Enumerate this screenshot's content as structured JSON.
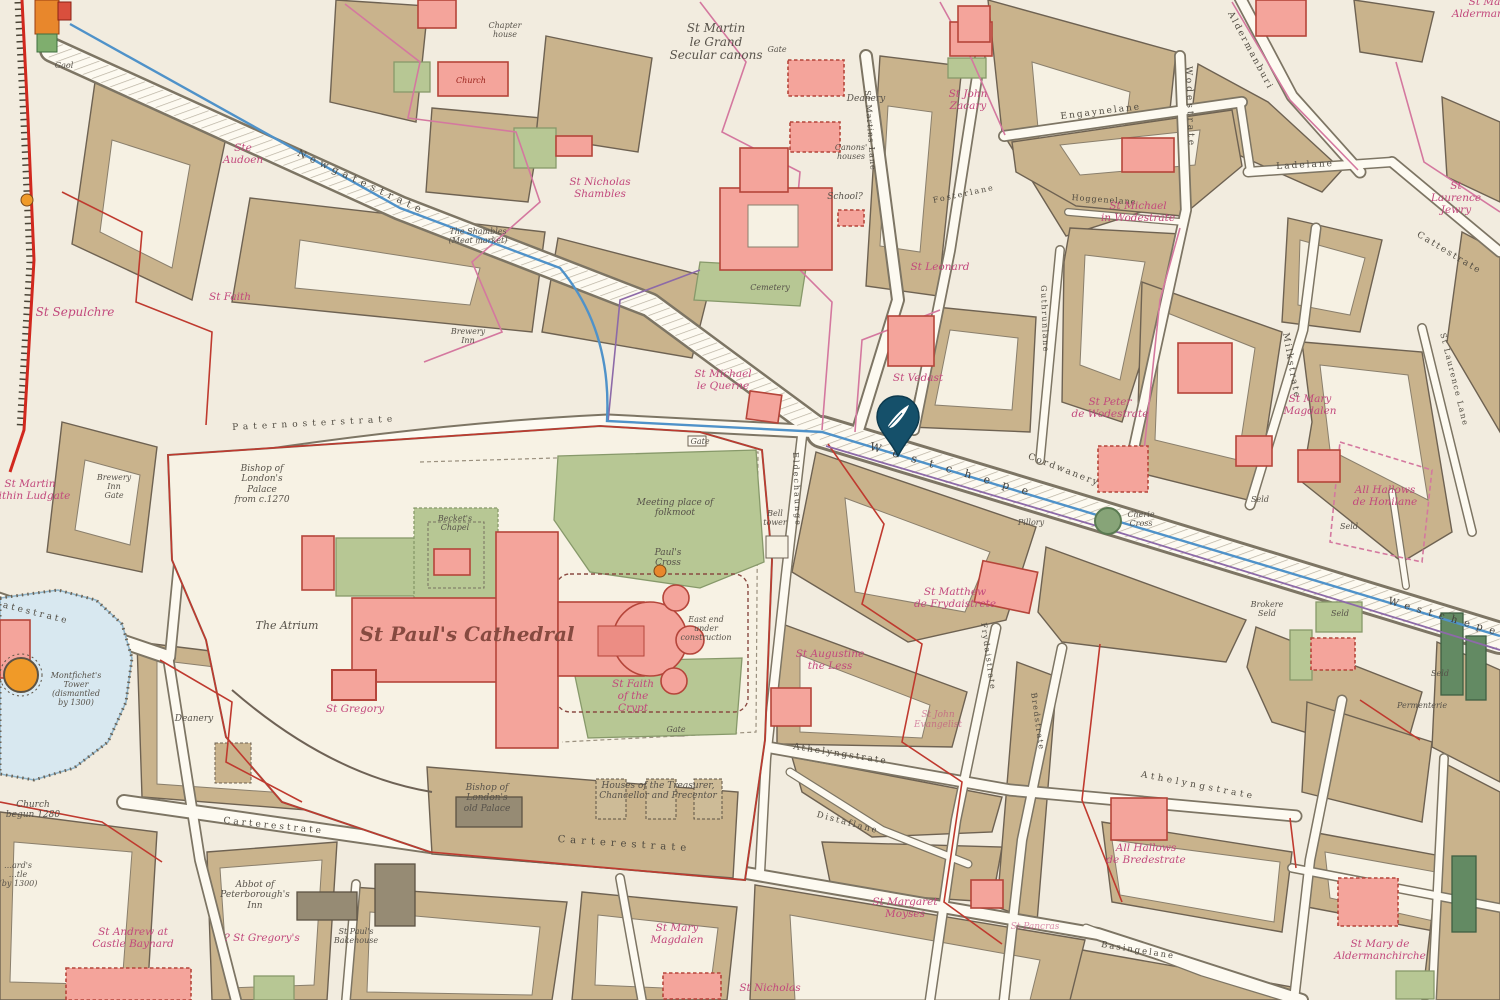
{
  "map": {
    "kind": "historical-city-map-medieval-london",
    "marker": {
      "name": "location-pin",
      "color": "#15506a",
      "glyph": "quill"
    },
    "palette": {
      "parchment": "#f2ecdf",
      "block_tan": "#c9b38c",
      "street": "#fdfaf1",
      "church_pink": "#f4a49b",
      "green": "#b7c794",
      "dark_green": "#638a63",
      "water": "#d8e8f0",
      "wall_red": "#d1281e",
      "boundary_pink": "#d4789f",
      "boundary_crimson": "#bf3a2f",
      "conduit_blue": "#4f92c9",
      "label_pink": "#c2487c",
      "pin": "#15506a"
    },
    "labels": [
      {
        "id": "lbl-gaol",
        "t": "Gaol",
        "x": 64,
        "y": 62,
        "c": "place-xs"
      },
      {
        "id": "lbl-chapter-house",
        "t": "Chapter\nhouse",
        "x": 505,
        "y": 22,
        "c": "place-xs"
      },
      {
        "id": "lbl-church-greyfriars",
        "t": "Church",
        "x": 471,
        "y": 76,
        "c": "red-sm"
      },
      {
        "id": "lbl-ste-audoen",
        "t": "Ste\nAudoen",
        "x": 243,
        "y": 142,
        "c": "church"
      },
      {
        "id": "lbl-st-sepulchre",
        "t": "St Sepulchre",
        "x": 75,
        "y": 306,
        "c": "church",
        "f": 12
      },
      {
        "id": "lbl-st-faith",
        "t": "St Faith",
        "x": 230,
        "y": 291,
        "c": "church"
      },
      {
        "id": "lbl-st-nicholas-shambles",
        "t": "St Nicholas\nShambles",
        "x": 600,
        "y": 176,
        "c": "church"
      },
      {
        "id": "lbl-shambles",
        "t": "The Shambles\n(Meat market)",
        "x": 478,
        "y": 228,
        "c": "place-xs"
      },
      {
        "id": "lbl-newgatestrate",
        "t": "Newgatestrate",
        "x": 300,
        "y": 148,
        "c": "street",
        "r": 25,
        "s": 5,
        "f": 10
      },
      {
        "id": "lbl-st-martin-le-grand",
        "t": "St Martin\nle Grand\nSecular canons",
        "x": 716,
        "y": 22,
        "c": "place",
        "f": 12
      },
      {
        "id": "lbl-gate-martin",
        "t": "Gate",
        "x": 777,
        "y": 46,
        "c": "place-xs"
      },
      {
        "id": "lbl-deanery-martin",
        "t": "Deanery",
        "x": 866,
        "y": 94,
        "c": "place-sm"
      },
      {
        "id": "lbl-canons-houses",
        "t": "Canons'\nhouses",
        "x": 851,
        "y": 144,
        "c": "place-xs"
      },
      {
        "id": "lbl-school",
        "t": "School?",
        "x": 845,
        "y": 192,
        "c": "place-sm"
      },
      {
        "id": "lbl-st-john-zacary",
        "t": "St John\nZacary",
        "x": 968,
        "y": 88,
        "c": "church"
      },
      {
        "id": "lbl-st-leonard",
        "t": "St Leonard",
        "x": 940,
        "y": 261,
        "c": "church"
      },
      {
        "id": "lbl-cemetery",
        "t": "Cemetery",
        "x": 770,
        "y": 284,
        "c": "place-xs"
      },
      {
        "id": "lbl-st-michael-le-querne",
        "t": "St Michael\nle Querne",
        "x": 723,
        "y": 368,
        "c": "church"
      },
      {
        "id": "lbl-st-vedast",
        "t": "St Vedast",
        "x": 918,
        "y": 372,
        "c": "church"
      },
      {
        "id": "lbl-engaynelane",
        "t": "Engaynelane",
        "x": 1060,
        "y": 112,
        "c": "street",
        "r": -7,
        "s": 2
      },
      {
        "id": "lbl-hoggenelane",
        "t": "Hoggenelane",
        "x": 1072,
        "y": 193,
        "c": "street",
        "r": 4,
        "s": 1,
        "f": 8
      },
      {
        "id": "lbl-st-michael-wodestrate",
        "t": "St Michael\nin Wodestrate",
        "x": 1138,
        "y": 200,
        "c": "church"
      },
      {
        "id": "lbl-wodestrate",
        "t": "Wodestrate",
        "x": 1193,
        "y": 66,
        "c": "street",
        "r": 88,
        "s": 3
      },
      {
        "id": "lbl-st-martins-lane",
        "t": "St Martins Lane",
        "x": 872,
        "y": 90,
        "c": "street",
        "r": 86,
        "s": 1,
        "f": 8
      },
      {
        "id": "lbl-fosterlane",
        "t": "Fosterlane",
        "x": 932,
        "y": 196,
        "c": "street",
        "r": -12,
        "s": 2,
        "f": 8
      },
      {
        "id": "lbl-guthrunlane",
        "t": "Guthrunlane",
        "x": 1048,
        "y": 285,
        "c": "street",
        "r": 88,
        "s": 1.5,
        "f": 8
      },
      {
        "id": "lbl-aldermanburi",
        "t": "Aldermanburi",
        "x": 1234,
        "y": 10,
        "c": "street",
        "r": 62,
        "s": 2
      },
      {
        "id": "lbl-ladelane",
        "t": "Ladelane",
        "x": 1276,
        "y": 162,
        "c": "street",
        "r": -3,
        "s": 2
      },
      {
        "id": "lbl-cattestrate",
        "t": "Cattestrate",
        "x": 1420,
        "y": 230,
        "c": "street",
        "r": 31,
        "s": 2
      },
      {
        "id": "lbl-st-mary-aldermanbury",
        "t": "St Mary\nAldermanbury",
        "x": 1490,
        "y": -4,
        "c": "church"
      },
      {
        "id": "lbl-st-laurence-jewry",
        "t": "St Laurence\nJewry",
        "x": 1456,
        "y": 180,
        "c": "church"
      },
      {
        "id": "lbl-milkstrate",
        "t": "Milkstrate",
        "x": 1290,
        "y": 332,
        "c": "street",
        "r": 80,
        "s": 2
      },
      {
        "id": "lbl-st-mary-magdalen-milk",
        "t": "St Mary\nMagdalen",
        "x": 1310,
        "y": 393,
        "c": "church"
      },
      {
        "id": "lbl-st-laurence-lane",
        "t": "St Laurence Lane",
        "x": 1447,
        "y": 332,
        "c": "street",
        "r": 76,
        "s": 1.5,
        "f": 8
      },
      {
        "id": "lbl-all-hallows-honilane",
        "t": "All Hallows\nde Honilane",
        "x": 1385,
        "y": 484,
        "c": "church"
      },
      {
        "id": "lbl-st-peter-wodestrate",
        "t": "St Peter\nde Wodestrate",
        "x": 1110,
        "y": 396,
        "c": "church"
      },
      {
        "id": "lbl-cordwanery",
        "t": "Cordwanery",
        "x": 1030,
        "y": 452,
        "c": "street",
        "r": 21,
        "s": 2
      },
      {
        "id": "lbl-westchepe-1",
        "t": "Westchepe",
        "x": 872,
        "y": 440,
        "c": "street-big",
        "r": 16,
        "s": 13
      },
      {
        "id": "lbl-westchepe-2",
        "t": "Westchepe",
        "x": 1390,
        "y": 596,
        "c": "street-big",
        "r": 16,
        "s": 7,
        "f": 10
      },
      {
        "id": "lbl-pillory",
        "t": "Pillory",
        "x": 1031,
        "y": 519,
        "c": "place-xs"
      },
      {
        "id": "lbl-cherie-cross",
        "t": "Cherie\nCross",
        "x": 1141,
        "y": 511,
        "c": "place-xs"
      },
      {
        "id": "lbl-brokere-seld",
        "t": "Brokere\nSeld",
        "x": 1267,
        "y": 601,
        "c": "place-xs"
      },
      {
        "id": "lbl-seld-1",
        "t": "Seld",
        "x": 1340,
        "y": 610,
        "c": "place-xs"
      },
      {
        "id": "lbl-seld-2",
        "t": "Seld",
        "x": 1260,
        "y": 496,
        "c": "place-xs"
      },
      {
        "id": "lbl-seld-3",
        "t": "Seld",
        "x": 1349,
        "y": 523,
        "c": "place-xs"
      },
      {
        "id": "lbl-seld-4",
        "t": "Seld",
        "x": 1440,
        "y": 670,
        "c": "place-xs"
      },
      {
        "id": "lbl-permenterie",
        "t": "Permenterie",
        "x": 1422,
        "y": 702,
        "c": "place-xs"
      },
      {
        "id": "lbl-paternosterstrate",
        "t": "Paternosterstrate",
        "x": 232,
        "y": 423,
        "c": "street",
        "r": -3,
        "s": 5
      },
      {
        "id": "lbl-bishops-palace",
        "t": "Bishop of\nLondon's\nPalace\nfrom c.1270",
        "x": 262,
        "y": 464,
        "c": "place-sm"
      },
      {
        "id": "lbl-the-atrium",
        "t": "The Atrium",
        "x": 287,
        "y": 620,
        "c": "place",
        "f": 11
      },
      {
        "id": "lbl-beckets-chapel",
        "t": "Becket's\nChapel",
        "x": 455,
        "y": 515,
        "c": "place-xs"
      },
      {
        "id": "lbl-folkmoot",
        "t": "Meeting place of\nfolkmoot",
        "x": 675,
        "y": 498,
        "c": "place-sm"
      },
      {
        "id": "lbl-pauls-cross",
        "t": "Paul's\nCross",
        "x": 668,
        "y": 548,
        "c": "place-sm"
      },
      {
        "id": "lbl-bell-tower",
        "t": "Bell\ntower",
        "x": 775,
        "y": 510,
        "c": "place-xs"
      },
      {
        "id": "lbl-st-pauls-cathedral",
        "t": "St Paul's Cathedral",
        "x": 467,
        "y": 622,
        "c": "cathedral"
      },
      {
        "id": "lbl-east-end",
        "t": "East end\nunder\nconstruction",
        "x": 706,
        "y": 616,
        "c": "place-xs"
      },
      {
        "id": "lbl-st-faith-crypt",
        "t": "St Faith\nof the\nCrypt",
        "x": 633,
        "y": 678,
        "c": "church"
      },
      {
        "id": "lbl-gate-north",
        "t": "Gate",
        "x": 700,
        "y": 438,
        "c": "place-xs"
      },
      {
        "id": "lbl-gate-south",
        "t": "Gate",
        "x": 676,
        "y": 726,
        "c": "place-xs"
      },
      {
        "id": "lbl-st-gregory",
        "t": "St Gregory",
        "x": 355,
        "y": 703,
        "c": "church"
      },
      {
        "id": "lbl-deanery-pauls",
        "t": "Deanery",
        "x": 194,
        "y": 714,
        "c": "place-sm"
      },
      {
        "id": "lbl-montfichet",
        "t": "Montfichet's\nTower\n(dismantled\nby 1300)",
        "x": 76,
        "y": 672,
        "c": "place-xs"
      },
      {
        "id": "lbl-ludgatestrate",
        "t": "Ludgatestrate",
        "x": -30,
        "y": 592,
        "c": "street",
        "r": 14,
        "s": 3
      },
      {
        "id": "lbl-st-martin-ludgate",
        "t": "St Martin\nwithin Ludgate",
        "x": 30,
        "y": 478,
        "c": "church"
      },
      {
        "id": "lbl-brewery-inn",
        "t": "Brewery\nInn",
        "x": 468,
        "y": 328,
        "c": "place-xs"
      },
      {
        "id": "lbl-brewery-inn-gate",
        "t": "Brewery\nInn\nGate",
        "x": 114,
        "y": 474,
        "c": "place-xs"
      },
      {
        "id": "lbl-eldechaunge",
        "t": "Eldechaunge",
        "x": 800,
        "y": 452,
        "c": "street",
        "r": 88,
        "s": 2,
        "f": 8
      },
      {
        "id": "lbl-carterestrate-1",
        "t": "Carterestrate",
        "x": 224,
        "y": 816,
        "c": "street",
        "r": 6,
        "s": 3
      },
      {
        "id": "lbl-carterestrate-2",
        "t": "Carterestrate",
        "x": 558,
        "y": 834,
        "c": "street",
        "r": 4,
        "s": 5,
        "f": 10
      },
      {
        "id": "lbl-old-palace",
        "t": "Bishop of\nLondon's\nold Palace",
        "x": 487,
        "y": 783,
        "c": "place-sm"
      },
      {
        "id": "lbl-treasurer-houses",
        "t": "Houses of the Treasurer,\nChancellor and Precentor",
        "x": 658,
        "y": 781,
        "c": "place-sm"
      },
      {
        "id": "lbl-athelyngstrate-1",
        "t": "Athelyngstrate",
        "x": 794,
        "y": 742,
        "c": "street",
        "r": 9,
        "s": 2
      },
      {
        "id": "lbl-athelyngstrate-2",
        "t": "Athelyngstrate",
        "x": 1142,
        "y": 770,
        "c": "street",
        "r": 11,
        "s": 3.5
      },
      {
        "id": "lbl-distaflane",
        "t": "Distaflane",
        "x": 818,
        "y": 810,
        "c": "street",
        "r": 15,
        "s": 2,
        "f": 8.5
      },
      {
        "id": "lbl-st-matthew",
        "t": "St Matthew\nde Frydaistrete",
        "x": 955,
        "y": 586,
        "c": "church"
      },
      {
        "id": "lbl-st-augustine",
        "t": "St Augustine\nthe Less",
        "x": 830,
        "y": 648,
        "c": "church"
      },
      {
        "id": "lbl-st-john-evangelist",
        "t": "St John\nEvangelist",
        "x": 938,
        "y": 710,
        "c": "church faint",
        "f": 9
      },
      {
        "id": "lbl-frydaistrate",
        "t": "Frydaistrate",
        "x": 988,
        "y": 622,
        "c": "street",
        "r": 82,
        "s": 1.5,
        "f": 8
      },
      {
        "id": "lbl-bredstrate",
        "t": "Bredstrate",
        "x": 1038,
        "y": 692,
        "c": "street",
        "r": 82,
        "s": 1.5,
        "f": 8
      },
      {
        "id": "lbl-basingelane",
        "t": "Basingelane",
        "x": 1102,
        "y": 940,
        "c": "street",
        "r": 9,
        "s": 2,
        "f": 8.5
      },
      {
        "id": "lbl-st-margaret-moyses",
        "t": "St Margaret\nMoyses",
        "x": 905,
        "y": 896,
        "c": "church"
      },
      {
        "id": "lbl-st-mary-magdalen-s",
        "t": "St Mary\nMagdalen",
        "x": 677,
        "y": 922,
        "c": "church"
      },
      {
        "id": "lbl-st-nicholas",
        "t": "St Nicholas",
        "x": 770,
        "y": 982,
        "c": "church"
      },
      {
        "id": "lbl-st-pancras",
        "t": "St Pancras",
        "x": 1035,
        "y": 922,
        "c": "church faint",
        "f": 9
      },
      {
        "id": "lbl-all-hallows-bredestrate",
        "t": "All Hallows\nde Bredestrate",
        "x": 1146,
        "y": 842,
        "c": "church"
      },
      {
        "id": "lbl-st-mary-aldermanchirche",
        "t": "St Mary de\nAldermanchirche",
        "x": 1380,
        "y": 938,
        "c": "church"
      },
      {
        "id": "lbl-abbot-inn",
        "t": "Abbot of\nPeterborough's\nInn",
        "x": 255,
        "y": 880,
        "c": "place-sm"
      },
      {
        "id": "lbl-st-gregorys-q",
        "t": "? St Gregory's",
        "x": 262,
        "y": 932,
        "c": "church"
      },
      {
        "id": "lbl-st-andrew-baynard",
        "t": "St Andrew at\nCastle Baynard",
        "x": 133,
        "y": 926,
        "c": "church"
      },
      {
        "id": "lbl-bakehouse",
        "t": "St Paul's\nBakehouse",
        "x": 356,
        "y": 928,
        "c": "place-xs"
      },
      {
        "id": "lbl-church-1280",
        "t": "Church\nbegun 1280",
        "x": 33,
        "y": 800,
        "c": "place-sm"
      },
      {
        "id": "lbl-castle-fragment",
        "t": "…ard's\n…tle\n(by 1300)",
        "x": 18,
        "y": 862,
        "c": "place-xs"
      }
    ]
  }
}
